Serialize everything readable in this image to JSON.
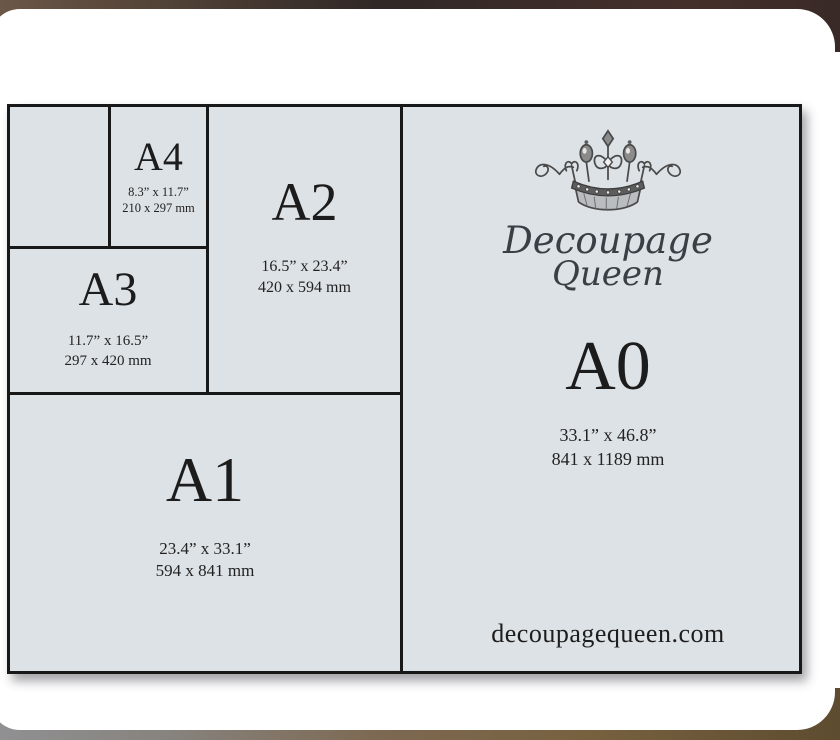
{
  "brand": {
    "name_line1": "Decoupage",
    "name_line2": "Queen",
    "website": "decoupagequeen.com",
    "crown_icon": "crown-icon"
  },
  "sizes": {
    "a4": {
      "label": "A4",
      "inches": "8.3” x 11.7”",
      "mm": "210 x 297 mm"
    },
    "a3": {
      "label": "A3",
      "inches": "11.7” x 16.5”",
      "mm": "297 x 420 mm"
    },
    "a2": {
      "label": "A2",
      "inches": "16.5” x 23.4”",
      "mm": "420 x 594 mm"
    },
    "a1": {
      "label": "A1",
      "inches": "23.4” x 33.1”",
      "mm": "594 x 841 mm"
    },
    "a0": {
      "label": "A0",
      "inches": "33.1” x 46.8”",
      "mm": "841 x 1189 mm"
    }
  },
  "colors": {
    "chart_background": "#dde2e6",
    "grid_line": "#181818",
    "text": "#1c1c1c",
    "card_background": "#ffffff"
  }
}
